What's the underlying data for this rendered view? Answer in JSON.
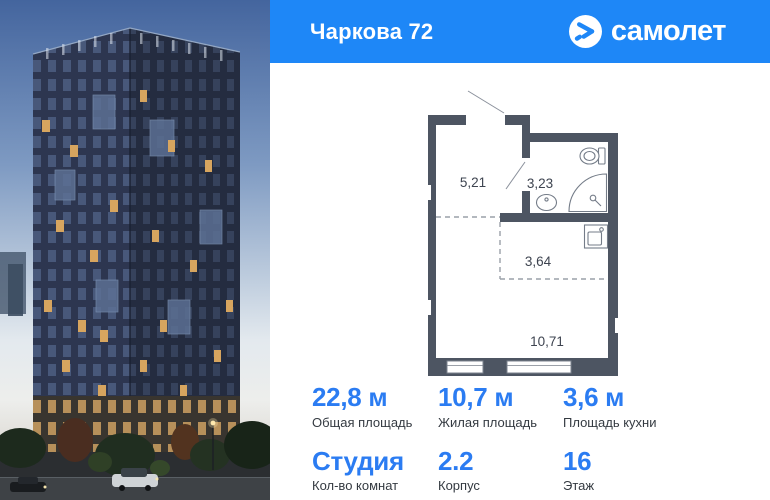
{
  "header": {
    "project_title": "Чаркова 72",
    "brand": "самолет"
  },
  "floorplan": {
    "rooms": [
      {
        "id": "hallway",
        "area_label": "5,21"
      },
      {
        "id": "bathroom",
        "area_label": "3,23"
      },
      {
        "id": "kitchen",
        "area_label": "3,64"
      },
      {
        "id": "living-room",
        "area_label": "10,71"
      }
    ]
  },
  "stats": {
    "items": [
      {
        "value": "22,8 м",
        "label": "Общая площадь"
      },
      {
        "value": "10,7 м",
        "label": "Жилая площадь"
      },
      {
        "value": "3,6 м",
        "label": "Площадь кухни"
      },
      {
        "value": "Студия",
        "label": "Кол-во комнат"
      },
      {
        "value": "2.2",
        "label": "Корпус"
      },
      {
        "value": "16",
        "label": "Этаж"
      }
    ]
  },
  "colors": {
    "brand_blue": "#1e87f7",
    "value_blue": "#2b7cf2",
    "plan_wall": "#4d5562"
  }
}
